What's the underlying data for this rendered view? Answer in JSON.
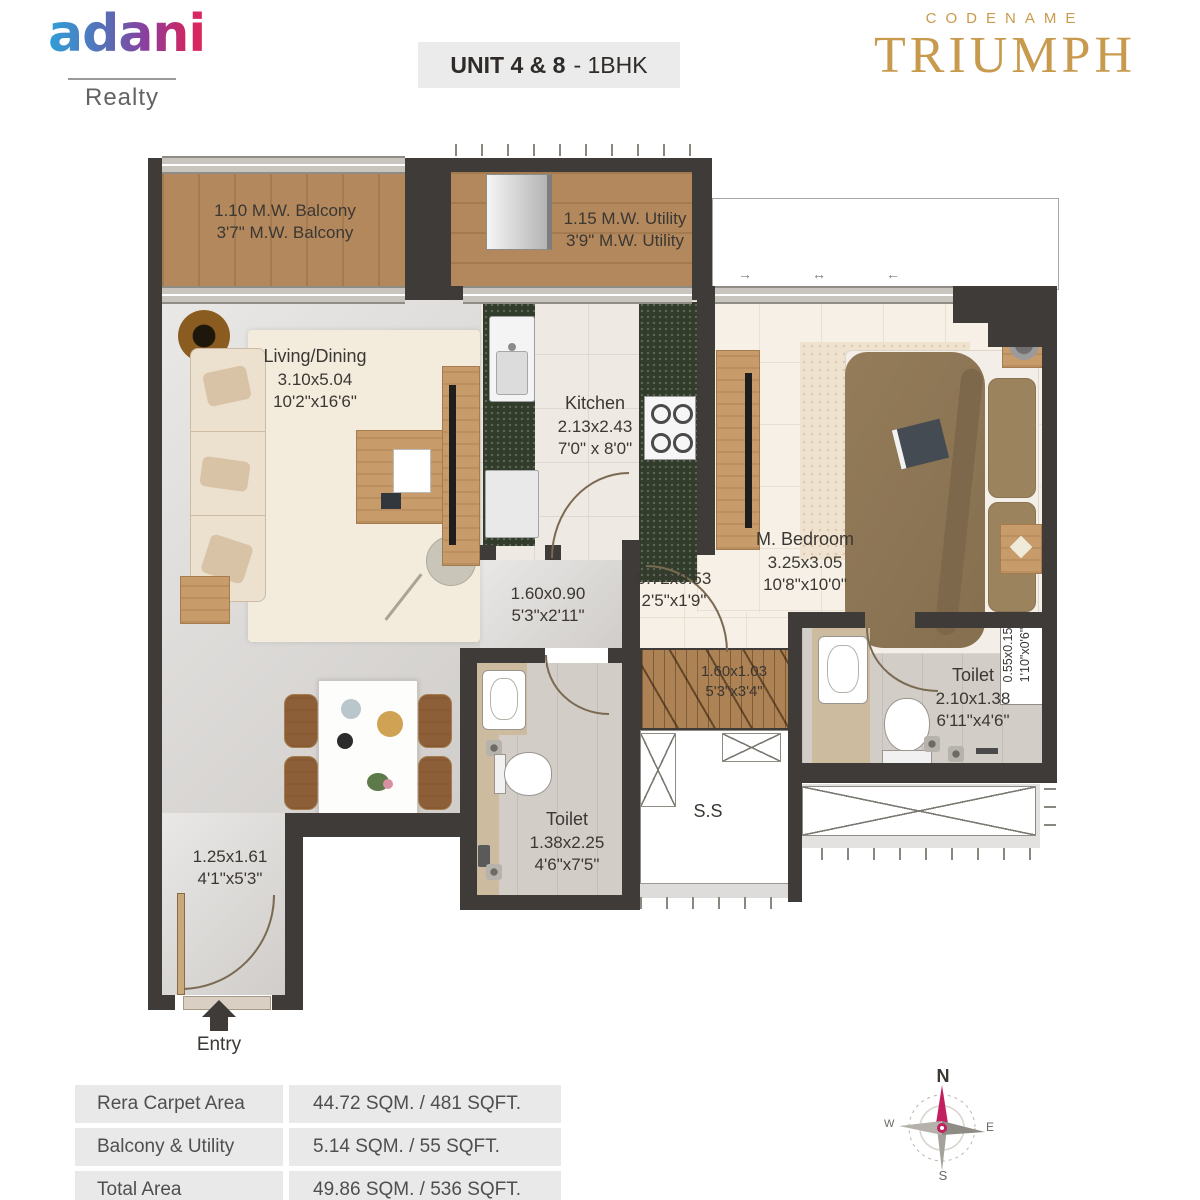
{
  "header": {
    "logo": {
      "name": "adani",
      "division": "Realty"
    },
    "unit_box": {
      "unit": "UNIT 4 & 8",
      "type": "- 1BHK"
    },
    "project": {
      "codename": "CODENAME",
      "title": "TRIUMPH"
    }
  },
  "plan": {
    "balcony": {
      "l1": "1.10 M.W. Balcony",
      "l2": "3'7\" M.W. Balcony"
    },
    "utility": {
      "l1": "1.15 M.W. Utility",
      "l2": "3'9\" M.W. Utility"
    },
    "living": {
      "name": "Living/Dining",
      "m": "3.10x5.04",
      "ft": "10'2\"x16'6\""
    },
    "kitchen": {
      "name": "Kitchen",
      "m": "2.13x2.43",
      "ft": "7'0\" x 8'0\""
    },
    "bedroom": {
      "name": "M. Bedroom",
      "m": "3.25x3.05",
      "ft": "10'8\"x10'0\""
    },
    "passage": {
      "m": "1.60x0.90",
      "ft": "5'3\"x2'11\""
    },
    "bed_lobby": {
      "m": "0.72x0.53",
      "ft": "2'5\"x1'9\""
    },
    "wardrobe": {
      "m": "1.60x1.03",
      "ft": "5'3\"x3'4\""
    },
    "toilet_master": {
      "name": "Toilet",
      "m": "2.10x1.38",
      "ft": "6'11\"x4'6\""
    },
    "toilet_common": {
      "name": "Toilet",
      "m": "1.38x2.25",
      "ft": "4'6\"x7'5\""
    },
    "foyer": {
      "m": "1.25x1.61",
      "ft": "4'1\"x5'3\""
    },
    "duct": {
      "m": "0.55x0.15",
      "ft": "1'10\"x0'6\""
    },
    "shaft": "S.S",
    "entry": "Entry",
    "deck_arrows": [
      "→",
      "↔",
      "←"
    ]
  },
  "area_table": {
    "rows": [
      {
        "label": "Rera Carpet Area",
        "value": "44.72 SQM. / 481 SQFT."
      },
      {
        "label": "Balcony & Utility",
        "value": "5.14 SQM. / 55 SQFT."
      },
      {
        "label": "Total Area",
        "value": "49.86 SQM. / 536 SQFT."
      }
    ]
  },
  "compass": {
    "north": "N",
    "east": "E",
    "south": "S",
    "west": "W"
  },
  "colors": {
    "wall": "#3e3b39",
    "wood": "#b3885c",
    "granite": "#323c2b",
    "gold": "#c89a4d",
    "north_needle": "#c21f5e",
    "adani_blue": "#2f9fd8",
    "adani_pink": "#e0245a"
  }
}
